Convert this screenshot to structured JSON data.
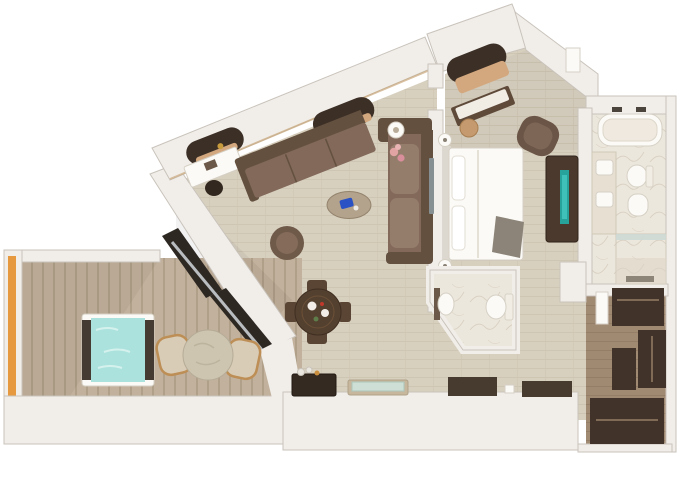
{
  "meta": {
    "title": "3D rendered floor plan of a suite with balcony",
    "view": "top-down 3D render",
    "visible_text": ""
  },
  "colors": {
    "bg": "#ffffff",
    "wall": "#f1eeea",
    "wall_edge": "#c9c3bb",
    "wall_shade": "#ddd8d1",
    "floor_wood": "#d8d0bf",
    "floor_wood_line": "#c7bca7",
    "deck": "#c2b19c",
    "deck_line": "#b0a089",
    "closet_floor": "#a18a72",
    "closet_floor_line": "#8d7760",
    "marble": "#ece7dc",
    "marble_vein": "#d3cabb",
    "dark_wood": "#42332a",
    "dark_wood2": "#5a4534",
    "table_wood": "#54402f",
    "sofa": "#82695a",
    "sofa_dark": "#64503f",
    "sofa_light": "#957d6c",
    "bed_white": "#fbfaf6",
    "fixture_edge": "#d6d0c5",
    "throw_gray": "#8c8478",
    "tan": "#d3a87e",
    "stone": "#cdc5b0",
    "teal_water": "#abe2dd",
    "teal_screen": "#27a39b",
    "orange": "#e6993f",
    "blue_accent": "#2a52c4",
    "pink": "#e2a3a3",
    "glass_dark": "#2e2823",
    "mat_dark": "#473a2e",
    "silver": "#b9bdc0",
    "window_dark": "#3c2f26",
    "sill": "#c9a87c"
  },
  "rooms": [
    {
      "name": "balcony",
      "furniture": [
        "hot-tub",
        "outdoor-table",
        "outdoor-chair-left",
        "outdoor-chair-right",
        "railing"
      ]
    },
    {
      "name": "living-room",
      "furniture": [
        "desk",
        "desk-chair",
        "l-shaped-sofa",
        "side-table",
        "coffee-table",
        "swivel-chair",
        "dining-table",
        "dining-chairs",
        "bar-cabinet",
        "bench",
        "wall-tv",
        "sliding-glass-door"
      ]
    },
    {
      "name": "bedroom",
      "furniture": [
        "double-bed",
        "bedside-lamp-top",
        "bedside-lamp-bottom",
        "vanity-desk",
        "vanity-stool",
        "armchair",
        "tv-console",
        "window-seat"
      ]
    },
    {
      "name": "master-bathroom",
      "furniture": [
        "bathtub",
        "double-sink-vanity",
        "toilet",
        "bidet",
        "shower"
      ]
    },
    {
      "name": "guest-bathroom",
      "furniture": [
        "sink",
        "toilet"
      ]
    },
    {
      "name": "walk-in-closet",
      "furniture": [
        "wardrobe-top",
        "wardrobe-right",
        "wardrobe-left",
        "wardrobe-bottom"
      ]
    },
    {
      "name": "entry-hall",
      "furniture": [
        "door-mat-left",
        "door-mat-right"
      ]
    }
  ],
  "windows": {
    "count": 3,
    "style": "rounded panoramic openings in angled hull wall"
  }
}
